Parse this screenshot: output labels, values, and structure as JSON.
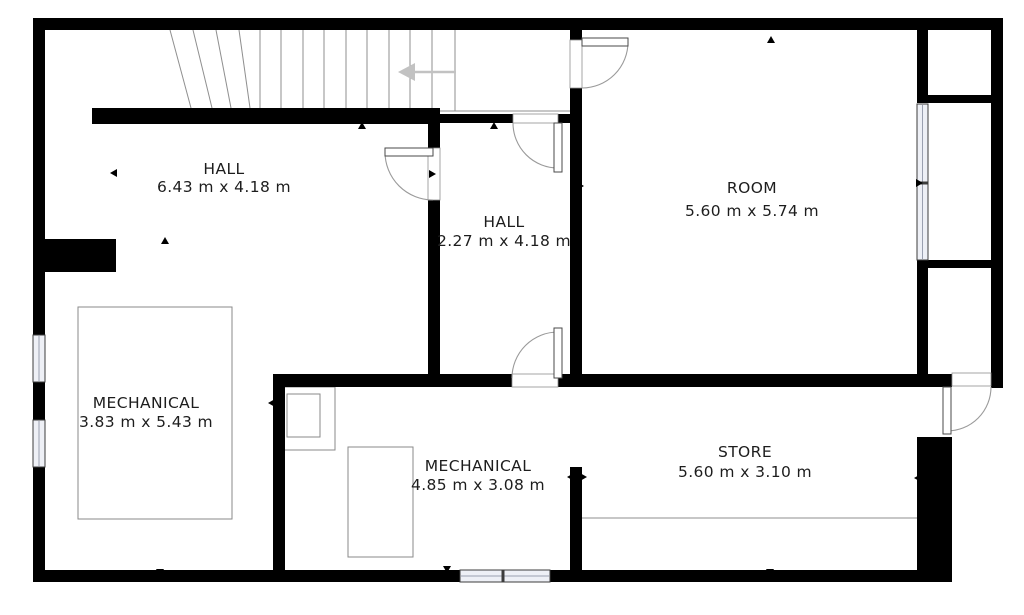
{
  "canvas": {
    "width": 1024,
    "height": 615,
    "background": "#ffffff",
    "wall_color": "#000000",
    "thin_line_color": "#8f8f8f",
    "door_arc_color": "#9a9a9a",
    "window_fill": "#eef0f6",
    "window_stroke": "#3c3c3c",
    "text_color": "#1d1d1d",
    "arrow_color": "#c2c2c2",
    "tick_color": "#000000"
  },
  "rooms": [
    {
      "name": "HALL",
      "dimensions": "6.43 m x 4.18 m",
      "cx": 224,
      "name_y": 169,
      "dim_y": 187
    },
    {
      "name": "HALL",
      "dimensions": "2.27 m x 4.18 m",
      "cx": 504,
      "name_y": 222,
      "dim_y": 241
    },
    {
      "name": "ROOM",
      "dimensions": "5.60 m x 5.74 m",
      "cx": 752,
      "name_y": 188,
      "dim_y": 211
    },
    {
      "name": "MECHANICAL",
      "dimensions": "3.83 m x 5.43 m",
      "cx": 146,
      "name_y": 403,
      "dim_y": 422
    },
    {
      "name": "MECHANICAL",
      "dimensions": "4.85 m x 3.08 m",
      "cx": 478,
      "name_y": 466,
      "dim_y": 485
    },
    {
      "name": "STORE",
      "dimensions": "5.60 m x 3.10 m",
      "cx": 745,
      "name_y": 452,
      "dim_y": 472
    }
  ],
  "walls": [
    [
      33,
      18,
      970,
      12
    ],
    [
      33,
      18,
      12,
      317
    ],
    [
      33,
      382,
      12,
      38
    ],
    [
      33,
      467,
      12,
      115
    ],
    [
      991,
      18,
      12,
      370
    ],
    [
      33,
      570,
      427,
      12
    ],
    [
      550,
      570,
      402,
      12
    ],
    [
      92,
      108,
      341,
      16
    ],
    [
      428,
      114,
      85,
      9
    ],
    [
      558,
      114,
      24,
      9
    ],
    [
      428,
      108,
      12,
      40
    ],
    [
      428,
      200,
      12,
      187
    ],
    [
      570,
      30,
      12,
      10
    ],
    [
      570,
      88,
      12,
      299
    ],
    [
      273,
      374,
      239,
      13
    ],
    [
      558,
      374,
      394,
      13
    ],
    [
      273,
      374,
      12,
      208
    ],
    [
      570,
      467,
      12,
      115
    ],
    [
      917,
      30,
      11,
      65
    ],
    [
      917,
      268,
      11,
      119
    ],
    [
      917,
      95,
      86,
      8
    ],
    [
      917,
      260,
      86,
      8
    ],
    [
      33,
      239,
      83,
      33
    ],
    [
      917,
      437,
      35,
      145
    ]
  ],
  "windows": [
    {
      "x": 33,
      "y": 335,
      "w": 12,
      "h": 47,
      "mullion": null
    },
    {
      "x": 33,
      "y": 420,
      "w": 12,
      "h": 47,
      "mullion": null
    },
    {
      "x": 460,
      "y": 570,
      "w": 90,
      "h": 12,
      "mullion": 503
    },
    {
      "x": 917,
      "y": 104,
      "w": 11,
      "h": 156,
      "mullion": 183
    }
  ],
  "doors": [
    {
      "frame": [
        428,
        148,
        12,
        52
      ],
      "leaf": [
        385,
        148,
        48,
        8
      ],
      "arc": "M385,152 A48,48 0 0 0 433,200"
    },
    {
      "frame": [
        513,
        114,
        45,
        9
      ],
      "leaf": [
        554,
        123,
        8,
        49
      ],
      "arc": "M513,123 A45,45 0 0 0 558,168"
    },
    {
      "frame": [
        570,
        40,
        12,
        48
      ],
      "leaf": [
        582,
        38,
        46,
        8
      ],
      "arc": "M628,42 A46,46 0 0 1 582,88"
    },
    {
      "frame": [
        512,
        374,
        46,
        13
      ],
      "leaf": [
        554,
        328,
        8,
        50
      ],
      "arc": "M512,378 A46,46 0 0 1 558,332"
    },
    {
      "frame": [
        952,
        373,
        39,
        13
      ],
      "leaf": [
        943,
        387,
        8,
        47
      ],
      "arc": "M991,387 A44,44 0 0 1 947,431"
    }
  ],
  "equipment": [
    [
      78,
      307,
      154,
      212
    ],
    [
      282,
      387,
      53,
      63
    ],
    [
      287,
      394,
      33,
      43
    ],
    [
      348,
      447,
      65,
      110
    ]
  ],
  "stairs": {
    "winders": [
      [
        170,
        30,
        191,
        108
      ],
      [
        193,
        30,
        212,
        108
      ],
      [
        216,
        30,
        231,
        108
      ],
      [
        239,
        30,
        250,
        108
      ]
    ],
    "treads": [
      [
        260,
        30,
        260,
        108
      ],
      [
        281,
        30,
        281,
        108
      ],
      [
        303,
        30,
        303,
        108
      ],
      [
        324,
        30,
        324,
        108
      ],
      [
        346,
        30,
        346,
        108
      ],
      [
        367,
        30,
        367,
        108
      ],
      [
        389,
        30,
        389,
        108
      ],
      [
        410,
        30,
        410,
        108
      ],
      [
        432,
        30,
        432,
        108
      ],
      [
        455,
        30,
        455,
        111
      ]
    ],
    "landing_line": [
      440,
      111,
      570,
      111
    ],
    "arrow": {
      "line": [
        414,
        72,
        456,
        72
      ],
      "head": "398,72 415,63 415,81"
    }
  },
  "extra_lines": [
    [
      582,
      518,
      917,
      518
    ]
  ],
  "ticks": [
    {
      "x": 362,
      "y": 126,
      "d": "up"
    },
    {
      "x": 494,
      "y": 126,
      "d": "up"
    },
    {
      "x": 771,
      "y": 40,
      "d": "up"
    },
    {
      "x": 40,
      "y": 173,
      "d": "right"
    },
    {
      "x": 114,
      "y": 173,
      "d": "left"
    },
    {
      "x": 432,
      "y": 174,
      "d": "right"
    },
    {
      "x": 580,
      "y": 186,
      "d": "right"
    },
    {
      "x": 919,
      "y": 183,
      "d": "right"
    },
    {
      "x": 436,
      "y": 243,
      "d": "right"
    },
    {
      "x": 575,
      "y": 243,
      "d": "left"
    },
    {
      "x": 41,
      "y": 403,
      "d": "right"
    },
    {
      "x": 272,
      "y": 403,
      "d": "left"
    },
    {
      "x": 165,
      "y": 241,
      "d": "up"
    },
    {
      "x": 160,
      "y": 572,
      "d": "down"
    },
    {
      "x": 447,
      "y": 382,
      "d": "up"
    },
    {
      "x": 490,
      "y": 378,
      "d": "down"
    },
    {
      "x": 447,
      "y": 569,
      "d": "down"
    },
    {
      "x": 770,
      "y": 378,
      "d": "down"
    },
    {
      "x": 770,
      "y": 572,
      "d": "down"
    },
    {
      "x": 918,
      "y": 478,
      "d": "left"
    },
    {
      "x": 571,
      "y": 477,
      "d": "left"
    },
    {
      "x": 583,
      "y": 477,
      "d": "right"
    }
  ]
}
